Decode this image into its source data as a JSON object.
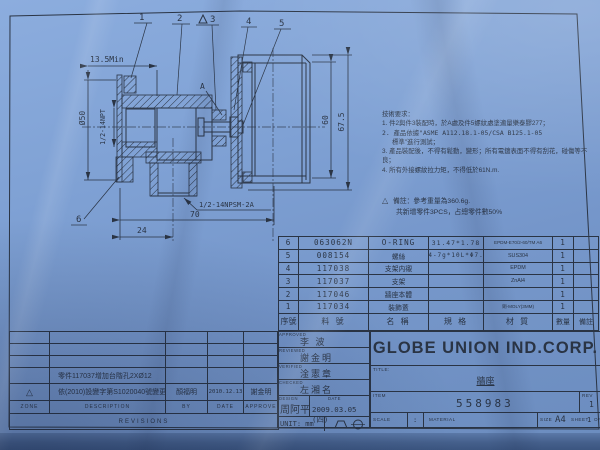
{
  "colors": {
    "paper": "#7d9fd3",
    "ink": "#2a3444"
  },
  "drawing": {
    "callouts": {
      "c1": "1",
      "c2": "2",
      "c3": "3",
      "c4": "4",
      "c5": "5",
      "c6": "6",
      "a": "A"
    },
    "dimensions": {
      "min135": "13.5Min",
      "dia50": "Ø50",
      "npt": "1/2-14NPT",
      "npsm": "1/2-14NPSM-2A",
      "d70": "70",
      "d24": "24",
      "d60": "60",
      "d675": "67.5"
    }
  },
  "notes": {
    "heading": "技術要求：",
    "n1": "1. 件2與件3裝配時，於A處及件5螺紋處塗適量樂泰膠277；",
    "n2a": "2. 產品依據\"ASME A112.18.1-05/CSA B125.1-05",
    "n2b": "標準\"進行測試；",
    "n3": "3. 產品裝配後，不得有鬆動，變形；所有電鍍表面不得有刮花，碰傷等不良；",
    "n4": "4. 所有外接螺紋拉力矩，不得低於61N.m.",
    "remark_triangle": "△",
    "remark1": "備註：參考重量為360.6g.",
    "remark2": "共新增零件3PCS，占總零件數50%"
  },
  "parts": {
    "headers": {
      "no": "序號",
      "pn": "料 號",
      "name": "名  稱",
      "spec": "規  格",
      "mat": "材  質",
      "qty": "數量",
      "note": "備註"
    },
    "rows": [
      {
        "no": "6",
        "pn": "063062N",
        "name": "O-RING",
        "spec": "31.47*1.78",
        "mat": "EPDM-E70/2-60/TM A6",
        "qty": "1",
        "note": ""
      },
      {
        "no": "5",
        "pn": "008154",
        "name": "螺絲",
        "spec": "M4-7g*10L*Φ7.3",
        "mat": "SUS304",
        "qty": "1",
        "note": ""
      },
      {
        "no": "4",
        "pn": "117038",
        "name": "支架内襯",
        "spec": "",
        "mat": "EPDM",
        "qty": "1",
        "note": ""
      },
      {
        "no": "3",
        "pn": "117037",
        "name": "支架",
        "spec": "",
        "mat": "ZnAl4",
        "qty": "1",
        "note": ""
      },
      {
        "no": "2",
        "pn": "117046",
        "name": "牆座本體",
        "spec": "",
        "mat": "",
        "qty": "1",
        "note": ""
      },
      {
        "no": "1",
        "pn": "117034",
        "name": "裝飾蓋",
        "spec": "",
        "mat": "銅-MOLY(3MM)",
        "qty": "1",
        "note": ""
      }
    ]
  },
  "revisions": {
    "desc_row": "零件117037增加台階孔2XØ12",
    "rev_row": {
      "zone": "△",
      "desc": "依(2010)設變字第S1020040號變更",
      "by": "顏福明",
      "date": "2010.12.13",
      "approve": "謝金明"
    },
    "headers": {
      "zone": "ZONE",
      "desc": "DESCRIPTION",
      "by": "BY",
      "date": "DATE",
      "approve": "APPROVE"
    },
    "band": "REVISIONS"
  },
  "titleblock": {
    "approved_label": "APPROVED",
    "approved": "李 波",
    "reviewed_label": "REVIEWED",
    "reviewed": "謝金明",
    "verified_label": "VERIFIED",
    "verified": "淦憲章",
    "checked_label": "CHECKED",
    "checked": "左湘名",
    "design_label": "DESIGN",
    "designer": "周阿平",
    "date_label": "DATE",
    "date": "2009.03.05 (四)",
    "unit": "UNIT: mm",
    "company": "GLOBE UNION IND.CORP.",
    "title_label": "TITLE:",
    "title": "牆座",
    "item_label": "ITEM",
    "item": "558983",
    "rev_label": "REV",
    "rev_value": "1",
    "scale_label": "SCALE",
    "scale_sep": ":",
    "material_label": "MATERIAL",
    "size_label": "SIZE",
    "size": "A4",
    "sheet_label": "SHEET",
    "sheet": "1",
    "of_label": "OF"
  }
}
